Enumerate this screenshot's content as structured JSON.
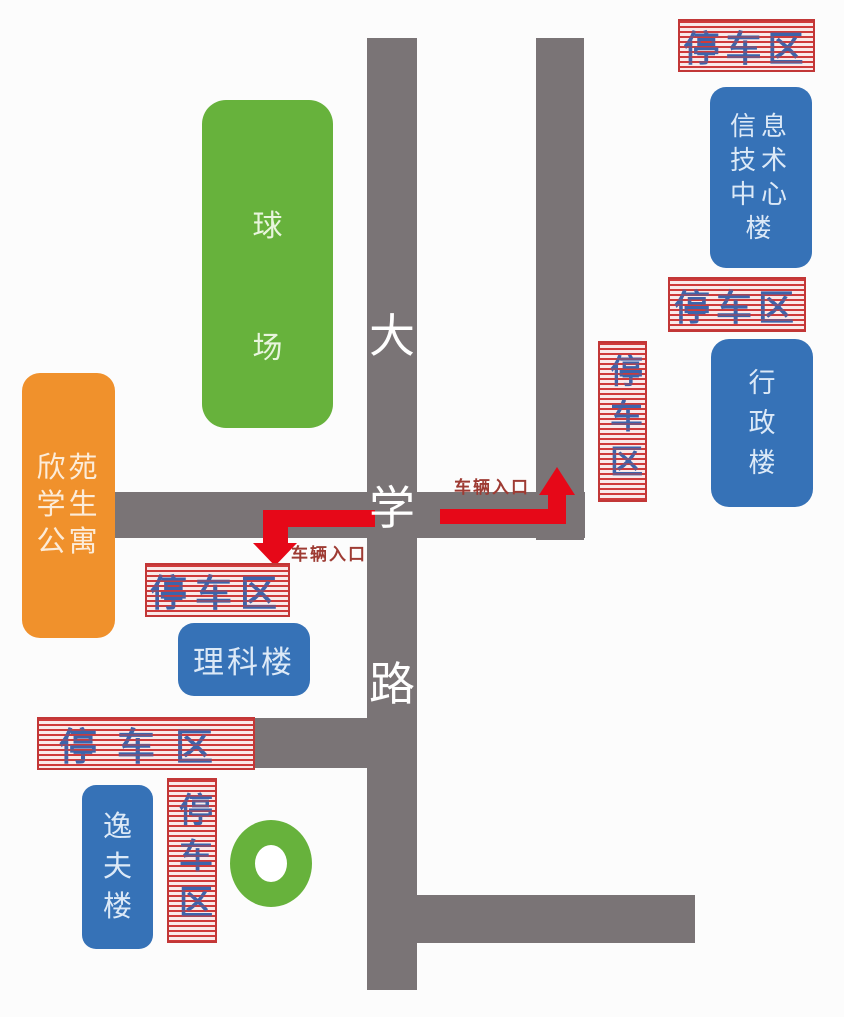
{
  "road": {
    "name": "大学路",
    "chars": [
      "大",
      "学",
      "路"
    ]
  },
  "buildings": {
    "ballfield": {
      "name": "球场",
      "lines": [
        "球",
        "场"
      ]
    },
    "apartment": {
      "name": "欣苑学生公寓",
      "lines": [
        "欣苑",
        "学生",
        "公寓"
      ]
    },
    "it_center": {
      "name": "信息技术中心楼",
      "lines": [
        "信息",
        "技术",
        "中心",
        "楼"
      ]
    },
    "admin": {
      "name": "行政楼",
      "lines": [
        "行",
        "政",
        "楼"
      ]
    },
    "science": {
      "name": "理科楼"
    },
    "yifu": {
      "name": "逸夫楼",
      "lines": [
        "逸",
        "夫",
        "楼"
      ]
    }
  },
  "parking_areas": [
    {
      "id": "top-right",
      "label": "停车区"
    },
    {
      "id": "right-upper",
      "label": "停车区"
    },
    {
      "id": "right-roadside",
      "label": "停车区"
    },
    {
      "id": "science-north",
      "label": "停车区"
    },
    {
      "id": "southwest",
      "label": "停车区"
    },
    {
      "id": "yifu-east",
      "label": "停车区"
    }
  ],
  "vehicle_entrances": [
    {
      "id": "east-entrance",
      "label": "车辆入口"
    },
    {
      "id": "west-entrance",
      "label": "车辆入口"
    }
  ],
  "colors": {
    "road": "#7a7476",
    "field-green": "#67b23c",
    "apartment-orange": "#f0912c",
    "building-blue": "#3672b7",
    "arrow-red": "#e60818",
    "stripe-red": "#cf3a3a",
    "banner-text": "#3c64ab",
    "entrance-text": "#9e3b33"
  }
}
